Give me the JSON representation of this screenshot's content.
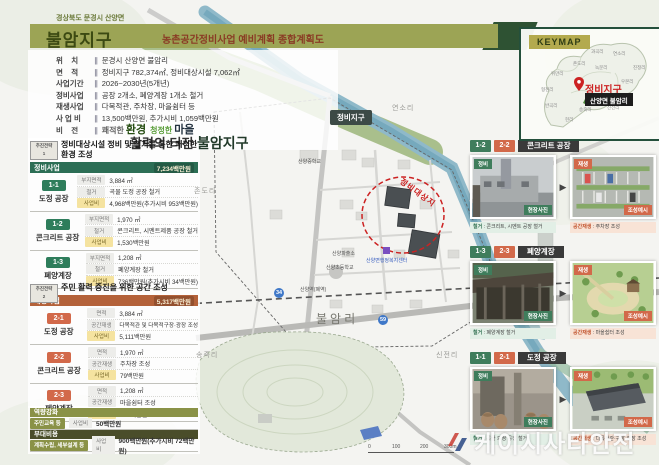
{
  "header": {
    "region": "경상북도 문경시 산양면",
    "title": "불암지구",
    "subtitle": "농촌공간정비사업 예비계획  종합계획도",
    "divider": "∥",
    "info": [
      {
        "label": "위    치",
        "value": "문경시 산양면 불암리"
      },
      {
        "label": "면    적",
        "value": "정비지구 782,374㎡, 정비대상시설 7,062㎡"
      },
      {
        "label": "사업기간",
        "value": "2026~2030년(5개년)"
      },
      {
        "label": "정비사업",
        "value": "공장 2개소, 폐양계장 1개소 철거"
      },
      {
        "label": "재생사업",
        "value": "다목적관, 주차장, 마을쉼터 등"
      },
      {
        "label": "사 업 비",
        "value": "13,500백만원, 추가시비 1,059백만원"
      },
      {
        "label": "비    전",
        "value": ""
      }
    ],
    "vision": {
      "w1": "쾌적한",
      "w2": "환경",
      "w3": "청정한",
      "w4": "마을",
      "line2a": "활력의 터전",
      "line2b": "불암지구"
    }
  },
  "strategy1": {
    "badge_line1": "추진전략",
    "badge_no": "1",
    "title": "정비대상시설 정비 및 철거를 통한 쾌적한 환경 조성",
    "header_label": "정비사업",
    "header_total": "7,234백만원",
    "groups": [
      {
        "no": "1-1",
        "name": "도정 공장",
        "rows": [
          {
            "label": "부지면적",
            "value": "3,884 ㎡"
          },
          {
            "label": "철거",
            "value": "곡물 도정 공장 철거"
          },
          {
            "label": "사업비",
            "value": "4,968백만원(추가시비 953백만원)"
          }
        ]
      },
      {
        "no": "1-2",
        "name": "콘크리트 공장",
        "rows": [
          {
            "label": "부지면적",
            "value": "1,970 ㎡"
          },
          {
            "label": "철거",
            "value": "콘크리트, 시멘트제품 공장 철거"
          },
          {
            "label": "사업비",
            "value": "1,530백만원"
          }
        ]
      },
      {
        "no": "1-3",
        "name": "폐양계장",
        "rows": [
          {
            "label": "부지면적",
            "value": "1,208 ㎡"
          },
          {
            "label": "철거",
            "value": "폐양계장 철거"
          },
          {
            "label": "사업비",
            "value": "736백만원(추가시비 34백만원)"
          }
        ]
      }
    ]
  },
  "strategy2": {
    "badge_line1": "추진전략",
    "badge_no": "2",
    "title": "주민 활력 증진을 위한 공간 조성",
    "header_label": "재생사업",
    "header_total": "5,317백만원",
    "groups": [
      {
        "no": "2-1",
        "name": "도정 공장",
        "rows": [
          {
            "label": "면적",
            "value": "3,884 ㎡"
          },
          {
            "label": "공간재생",
            "value": "다목적관 및 다목적구장·광장 조성"
          },
          {
            "label": "사업비",
            "value": "5,111백만원"
          }
        ]
      },
      {
        "no": "2-2",
        "name": "콘크리트 공장",
        "rows": [
          {
            "label": "면적",
            "value": "1,970 ㎡"
          },
          {
            "label": "공간재생",
            "value": "주차장 조성"
          },
          {
            "label": "사업비",
            "value": "79백만원"
          }
        ]
      },
      {
        "no": "2-3",
        "name": "폐양계장",
        "rows": [
          {
            "label": "면적",
            "value": "1,208 ㎡"
          },
          {
            "label": "공간재생",
            "value": "마을쉼터 조성"
          },
          {
            "label": "사업비",
            "value": "127백만원"
          }
        ]
      }
    ]
  },
  "capacity": {
    "header": "역량강화",
    "badge": "주민교육 등",
    "label": "사업비",
    "value": "50백만원"
  },
  "incidental": {
    "header": "부대비용",
    "badge": "계획수립, 세부설계 등",
    "label": "사업비",
    "value": "900백만원(추가시비 72백만원)"
  },
  "map": {
    "district_badge": "정비지구",
    "target_area_label": "정비대상지",
    "villages": {
      "yeonso": "연소리",
      "jondo": "존도리",
      "bulam": "불암리",
      "songjuk": "송죽리",
      "sinjeon": "신전리"
    },
    "facilities": {
      "school_mid": "산양중학교",
      "station": "산양역(폐역)",
      "police": "산양파출소",
      "school_elem": "산양초등학교",
      "office": "산양면행정복지센터"
    },
    "road_badge_34": "34",
    "road_badge_59": "59",
    "north": "N",
    "scale_ticks": [
      "0",
      "100",
      "200",
      "300m"
    ]
  },
  "keymap": {
    "label": "KEYMAP",
    "marker_label": "정비지구",
    "marker_badge": "산양면 불암리",
    "villages": [
      "현리",
      "반곡리",
      "형천리",
      "위만리",
      "연소리",
      "존도리",
      "진정리",
      "과곡리",
      "녹문리",
      "우본리",
      "송죽리",
      "신전리"
    ]
  },
  "cards": [
    {
      "no1": "1-2",
      "no2": "2-2",
      "title": "콘크리트 공장",
      "before_tag": "정비",
      "after_tag": "재생",
      "before_photo_label": "현장사진",
      "after_photo_label": "조성예시",
      "before_caption_label": "철거",
      "before_caption_text": "콘크리트, 시멘트 공장 철거",
      "after_caption_label": "공간재생",
      "after_caption_text": "주차장 조성"
    },
    {
      "no1": "1-3",
      "no2": "2-3",
      "title": "폐양계장",
      "before_tag": "정비",
      "after_tag": "재생",
      "before_photo_label": "현장사진",
      "after_photo_label": "조성예시",
      "before_caption_label": "철거",
      "before_caption_text": "폐양계장 철거",
      "after_caption_label": "공간재생",
      "after_caption_text": "마을쉼터 조성"
    },
    {
      "no1": "1-1",
      "no2": "2-1",
      "title": "도정 공장",
      "before_tag": "정비",
      "after_tag": "재생",
      "before_photo_label": "현장사진",
      "after_photo_label": "조성예시",
      "before_caption_label": "철거",
      "before_caption_text": "곡물 도정 공장 철거",
      "after_caption_label": "공간재생",
      "after_caption_text": "다목적관·구장·광장 조성"
    }
  ],
  "icons": {
    "arrow_right": "▶",
    "colon": " : "
  },
  "watermark": {
    "text": "케이시사타안전"
  },
  "colors": {
    "accent_green": "#2e7d5b",
    "accent_salmon": "#d2694a",
    "olive_bar": "#9ca455",
    "dark_green": "#2c6e55",
    "orange_bar": "#b4623a",
    "maroon": "#8a3b24"
  }
}
